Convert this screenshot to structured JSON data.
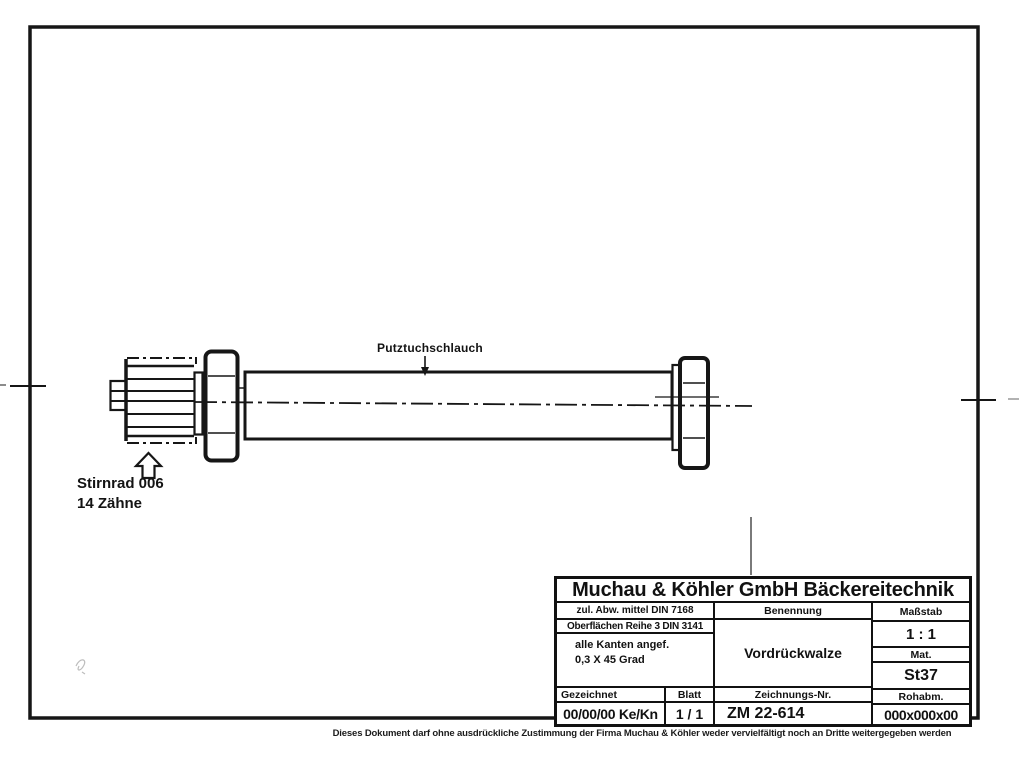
{
  "page": {
    "background": "#ffffff",
    "ink": "#161616"
  },
  "drawing": {
    "part_label": "Putztuchschlauch",
    "gear_label_line1": "Stirnrad 006",
    "gear_label_line2": "14 Zähne"
  },
  "title_block": {
    "company": "Muchau & Köhler GmbH Bäckereitechnik",
    "tolerance_note": "zul. Abw. mittel DIN 7168",
    "surface_note": "Oberflächen Reihe 3 DIN 3141",
    "edge_note_line1": "alle Kanten angef.",
    "edge_note_line2": "0,3 X 45 Grad",
    "benennung_label": "Benennung",
    "benennung_value": "Vordrückwalze",
    "massstab_label": "Maßstab",
    "massstab_value": "1 : 1",
    "mat_label": "Mat.",
    "mat_value": "St37",
    "rohabm_label": "Rohabm.",
    "rohabm_value": "000x000x00",
    "gezeichnet_label": "Gezeichnet",
    "gezeichnet_value": "00/00/00 Ke/Kn",
    "blatt_label": "Blatt",
    "blatt_value": "1 / 1",
    "zeichnungsnr_label": "Zeichnungs-Nr.",
    "zeichnungsnr_value": "ZM 22-614"
  },
  "footer": {
    "disclaimer": "Dieses Dokument darf ohne ausdrückliche Zustimmung der Firma Muchau & Köhler weder vervielfältigt noch an Dritte weitergegeben werden"
  }
}
